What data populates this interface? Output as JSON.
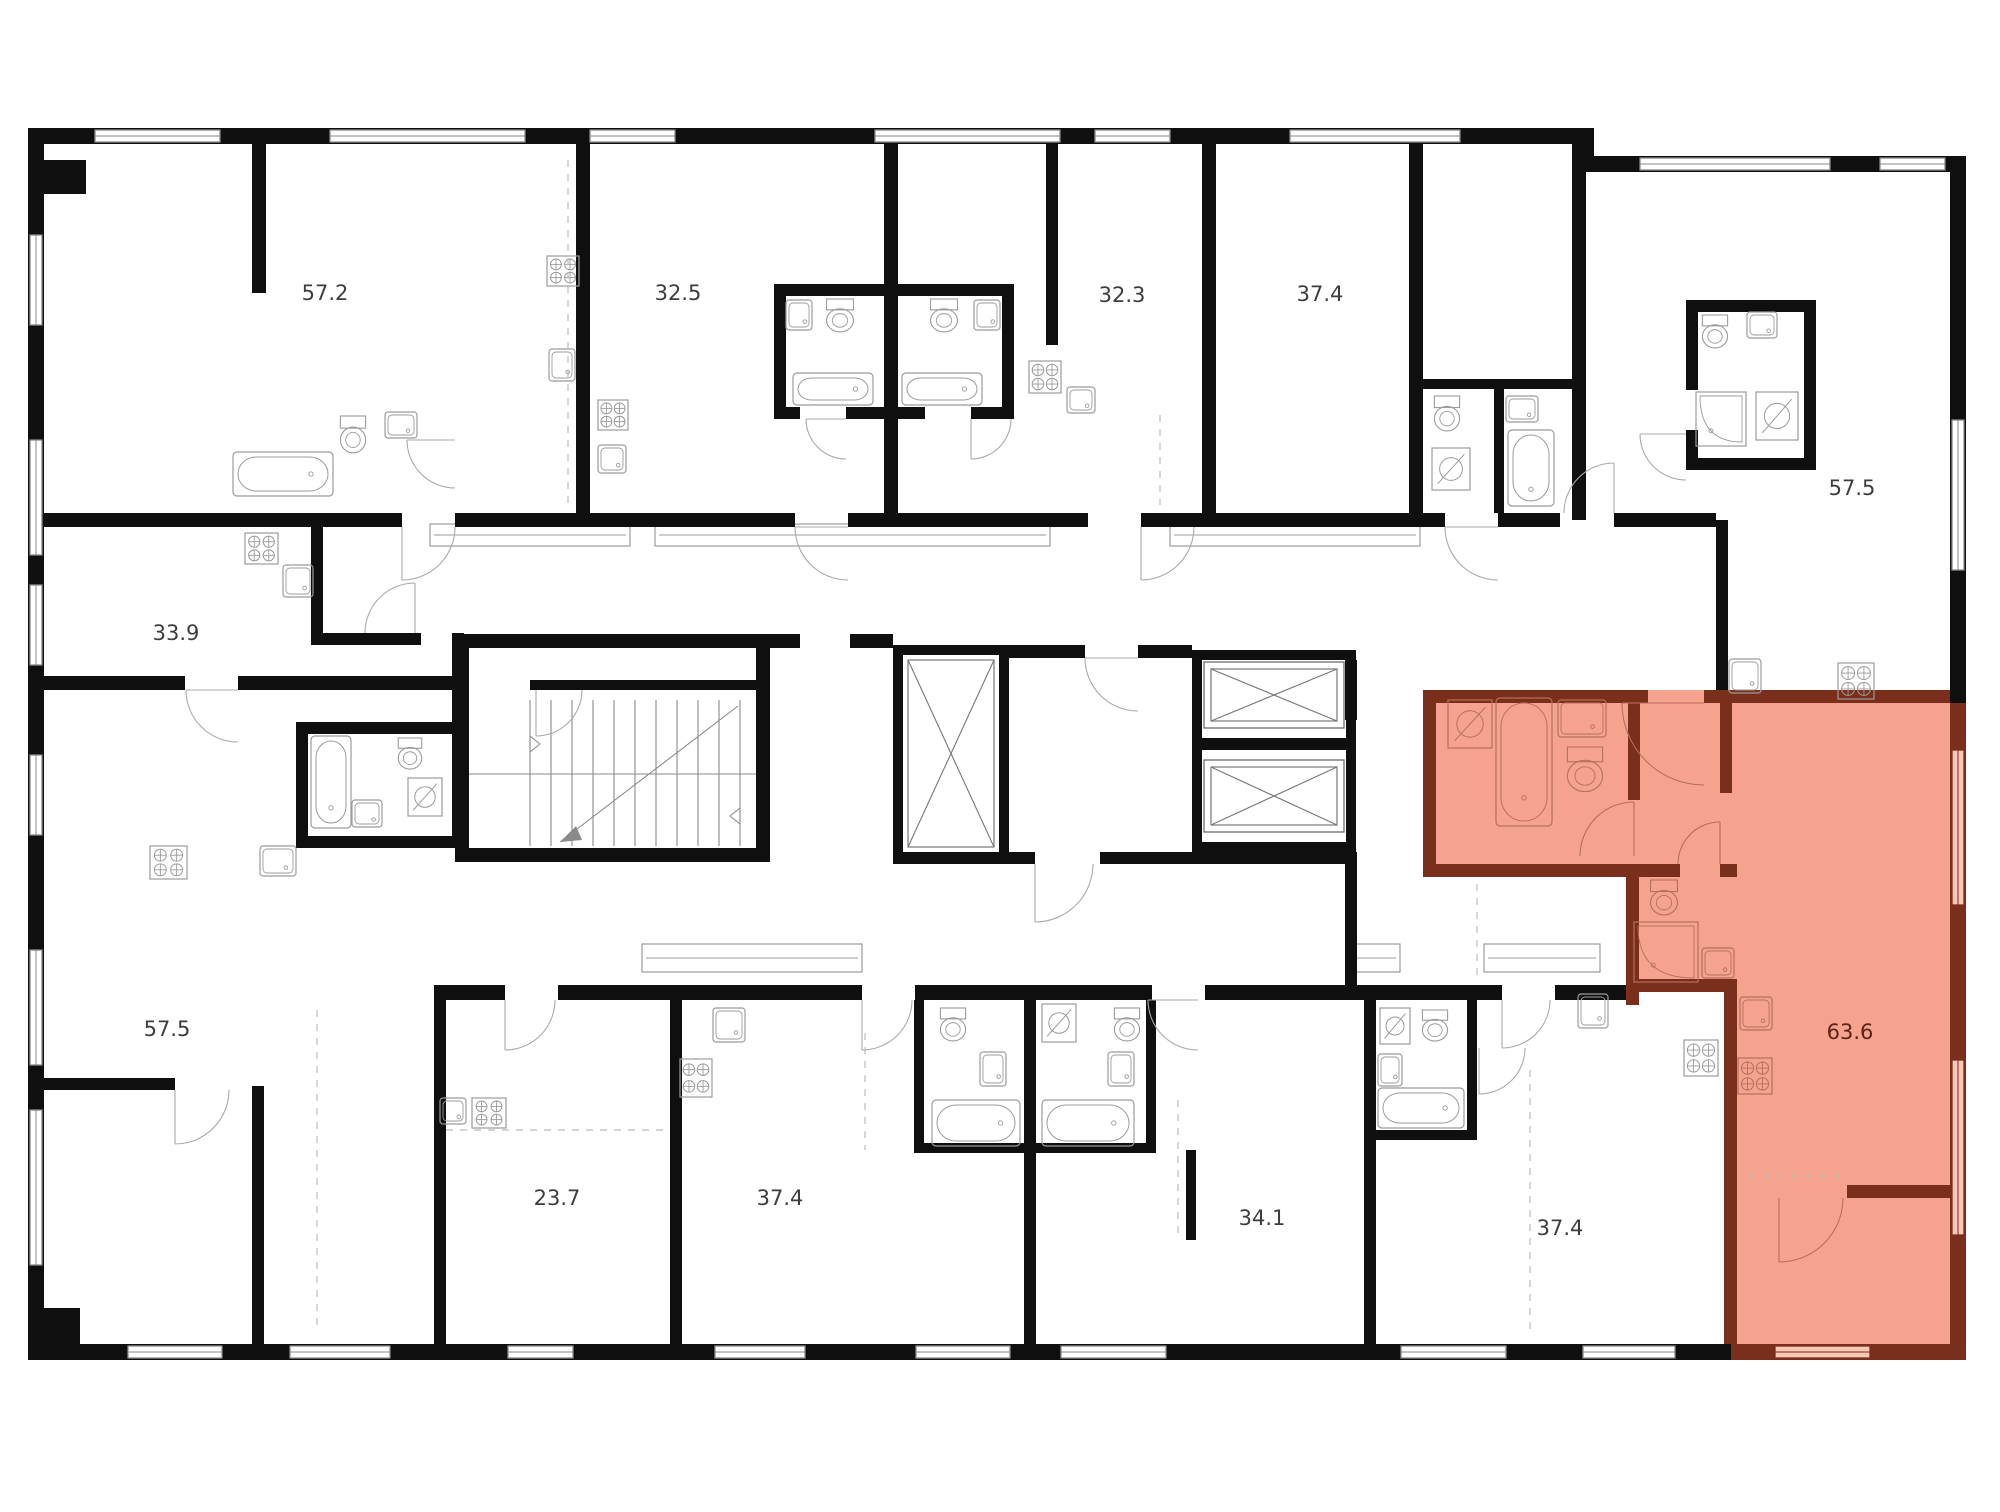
{
  "plan": {
    "title": "floor-plan",
    "colors": {
      "wall": "#0f0f0f",
      "highlight_fill": "#F5A38F",
      "highlight_wall": "#7A2E1C",
      "highlight_window_fill": "#F8C7B6",
      "highlight_label": "#5a2414",
      "fixture_line": "#9b9b9b",
      "fixture_line_selected": "#b5705a",
      "door_arc": "#aaaaaa",
      "dashed_line": "#bbbbbb",
      "label": "#3d3d3d",
      "background": "#ffffff"
    },
    "selected_apartment": {
      "area_label": "63.6"
    },
    "rooms": [
      {
        "label": "57.2",
        "x": 325,
        "y": 300,
        "selected": false
      },
      {
        "label": "32.5",
        "x": 678,
        "y": 300,
        "selected": false
      },
      {
        "label": "32.3",
        "x": 1122,
        "y": 302,
        "selected": false
      },
      {
        "label": "37.4",
        "x": 1320,
        "y": 301,
        "selected": false
      },
      {
        "label": "57.5",
        "x": 1852,
        "y": 495,
        "selected": false
      },
      {
        "label": "33.9",
        "x": 176,
        "y": 640,
        "selected": false
      },
      {
        "label": "57.5",
        "x": 167,
        "y": 1036,
        "selected": false
      },
      {
        "label": "23.7",
        "x": 557,
        "y": 1205,
        "selected": false
      },
      {
        "label": "37.4",
        "x": 780,
        "y": 1205,
        "selected": false
      },
      {
        "label": "34.1",
        "x": 1262,
        "y": 1225,
        "selected": false
      },
      {
        "label": "37.4",
        "x": 1560,
        "y": 1235,
        "selected": false
      },
      {
        "label": "63.6",
        "x": 1850,
        "y": 1039,
        "selected": true
      }
    ],
    "fixtures": [
      {
        "type": "stove",
        "name": "stove-icon",
        "x": 547,
        "y": 256,
        "w": 32,
        "h": 30,
        "sel": false
      },
      {
        "type": "sink",
        "name": "kitchen-sink-icon",
        "x": 549,
        "y": 349,
        "w": 26,
        "h": 32,
        "sel": false
      },
      {
        "type": "toilet",
        "name": "toilet-icon",
        "x": 338,
        "y": 416,
        "w": 30,
        "h": 38,
        "sel": false
      },
      {
        "type": "sink",
        "name": "bathroom-sink-icon",
        "x": 385,
        "y": 412,
        "w": 32,
        "h": 26,
        "sel": false
      },
      {
        "type": "tub-h",
        "name": "bathtub-icon",
        "x": 233,
        "y": 452,
        "w": 100,
        "h": 44,
        "sel": false
      },
      {
        "type": "stove",
        "name": "stove-icon",
        "x": 598,
        "y": 400,
        "w": 30,
        "h": 30,
        "sel": false
      },
      {
        "type": "sink",
        "name": "kitchen-sink-icon",
        "x": 598,
        "y": 445,
        "w": 28,
        "h": 28,
        "sel": false
      },
      {
        "type": "toilet",
        "name": "toilet-icon",
        "x": 824,
        "y": 299,
        "w": 32,
        "h": 34,
        "sel": false
      },
      {
        "type": "sink",
        "name": "bathroom-sink-icon",
        "x": 786,
        "y": 300,
        "w": 26,
        "h": 30,
        "sel": false
      },
      {
        "type": "tub-h",
        "name": "bathtub-icon",
        "x": 793,
        "y": 373,
        "w": 80,
        "h": 32,
        "sel": false
      },
      {
        "type": "toilet",
        "name": "toilet-icon",
        "x": 928,
        "y": 299,
        "w": 32,
        "h": 34,
        "sel": false
      },
      {
        "type": "sink",
        "name": "bathroom-sink-icon",
        "x": 974,
        "y": 300,
        "w": 26,
        "h": 30,
        "sel": false
      },
      {
        "type": "tub-h",
        "name": "bathtub-icon",
        "x": 902,
        "y": 373,
        "w": 80,
        "h": 32,
        "sel": false
      },
      {
        "type": "stove",
        "name": "stove-icon",
        "x": 1029,
        "y": 361,
        "w": 32,
        "h": 32,
        "sel": false
      },
      {
        "type": "sink",
        "name": "kitchen-sink-icon",
        "x": 1067,
        "y": 387,
        "w": 28,
        "h": 26,
        "sel": false
      },
      {
        "type": "toilet",
        "name": "toilet-icon",
        "x": 1432,
        "y": 396,
        "w": 30,
        "h": 36,
        "sel": false
      },
      {
        "type": "washer",
        "name": "washing-machine-icon",
        "x": 1432,
        "y": 448,
        "w": 38,
        "h": 42,
        "sel": false
      },
      {
        "type": "sink",
        "name": "bathroom-sink-icon",
        "x": 1506,
        "y": 396,
        "w": 32,
        "h": 26,
        "sel": false
      },
      {
        "type": "tub-v",
        "name": "bathtub-icon",
        "x": 1508,
        "y": 430,
        "w": 46,
        "h": 76,
        "sel": false
      },
      {
        "type": "toilet",
        "name": "toilet-icon",
        "x": 1700,
        "y": 315,
        "w": 30,
        "h": 34,
        "sel": false
      },
      {
        "type": "sink",
        "name": "bathroom-sink-icon",
        "x": 1747,
        "y": 312,
        "w": 30,
        "h": 26,
        "sel": false
      },
      {
        "type": "shower",
        "name": "shower-icon",
        "x": 1696,
        "y": 392,
        "w": 50,
        "h": 54,
        "sel": false
      },
      {
        "type": "washer",
        "name": "washing-machine-icon",
        "x": 1756,
        "y": 392,
        "w": 42,
        "h": 48,
        "sel": false
      },
      {
        "type": "sink",
        "name": "kitchen-sink-icon",
        "x": 1729,
        "y": 659,
        "w": 32,
        "h": 34,
        "sel": false
      },
      {
        "type": "stove",
        "name": "stove-icon",
        "x": 1838,
        "y": 663,
        "w": 36,
        "h": 36,
        "sel": false
      },
      {
        "type": "stove",
        "name": "stove-icon",
        "x": 245,
        "y": 533,
        "w": 33,
        "h": 31,
        "sel": false
      },
      {
        "type": "sink",
        "name": "kitchen-sink-icon",
        "x": 283,
        "y": 565,
        "w": 30,
        "h": 32,
        "sel": false
      },
      {
        "type": "tub-v",
        "name": "bathtub-icon",
        "x": 311,
        "y": 736,
        "w": 40,
        "h": 92,
        "sel": false
      },
      {
        "type": "toilet",
        "name": "toilet-icon",
        "x": 396,
        "y": 738,
        "w": 28,
        "h": 32,
        "sel": false
      },
      {
        "type": "sink",
        "name": "bathroom-sink-icon",
        "x": 352,
        "y": 800,
        "w": 30,
        "h": 27,
        "sel": false
      },
      {
        "type": "washer",
        "name": "washing-machine-icon",
        "x": 408,
        "y": 778,
        "w": 34,
        "h": 38,
        "sel": false
      },
      {
        "type": "stove",
        "name": "stove-icon",
        "x": 150,
        "y": 846,
        "w": 37,
        "h": 33,
        "sel": false
      },
      {
        "type": "sink",
        "name": "kitchen-sink-icon",
        "x": 260,
        "y": 846,
        "w": 36,
        "h": 30,
        "sel": false
      },
      {
        "type": "sink",
        "name": "kitchen-sink-icon",
        "x": 440,
        "y": 1098,
        "w": 26,
        "h": 26,
        "sel": false
      },
      {
        "type": "stove",
        "name": "stove-icon",
        "x": 472,
        "y": 1098,
        "w": 34,
        "h": 30,
        "sel": false
      },
      {
        "type": "sink",
        "name": "kitchen-sink-icon",
        "x": 713,
        "y": 1008,
        "w": 32,
        "h": 34,
        "sel": false
      },
      {
        "type": "stove",
        "name": "stove-icon",
        "x": 680,
        "y": 1059,
        "w": 32,
        "h": 38,
        "sel": false
      },
      {
        "type": "toilet",
        "name": "toilet-icon",
        "x": 938,
        "y": 1008,
        "w": 30,
        "h": 34,
        "sel": false
      },
      {
        "type": "sink",
        "name": "bathroom-sink-icon",
        "x": 980,
        "y": 1052,
        "w": 26,
        "h": 34,
        "sel": false
      },
      {
        "type": "tub-h",
        "name": "bathtub-icon",
        "x": 932,
        "y": 1100,
        "w": 88,
        "h": 46,
        "sel": false
      },
      {
        "type": "washer",
        "name": "washing-machine-icon",
        "x": 1042,
        "y": 1004,
        "w": 34,
        "h": 38,
        "sel": false
      },
      {
        "type": "toilet",
        "name": "toilet-icon",
        "x": 1112,
        "y": 1008,
        "w": 30,
        "h": 34,
        "sel": false
      },
      {
        "type": "sink",
        "name": "bathroom-sink-icon",
        "x": 1108,
        "y": 1052,
        "w": 26,
        "h": 34,
        "sel": false
      },
      {
        "type": "tub-h",
        "name": "bathtub-icon",
        "x": 1042,
        "y": 1100,
        "w": 92,
        "h": 46,
        "sel": false
      },
      {
        "type": "washer",
        "name": "washing-machine-icon",
        "x": 1380,
        "y": 1008,
        "w": 30,
        "h": 36,
        "sel": false
      },
      {
        "type": "toilet",
        "name": "toilet-icon",
        "x": 1420,
        "y": 1010,
        "w": 30,
        "h": 32,
        "sel": false
      },
      {
        "type": "sink",
        "name": "bathroom-sink-icon",
        "x": 1378,
        "y": 1054,
        "w": 24,
        "h": 32,
        "sel": false
      },
      {
        "type": "tub-h",
        "name": "bathtub-icon",
        "x": 1378,
        "y": 1088,
        "w": 86,
        "h": 40,
        "sel": false
      },
      {
        "type": "sink",
        "name": "kitchen-sink-icon",
        "x": 1578,
        "y": 994,
        "w": 30,
        "h": 34,
        "sel": false
      },
      {
        "type": "stove",
        "name": "stove-icon",
        "x": 1684,
        "y": 1040,
        "w": 34,
        "h": 36,
        "sel": false
      },
      {
        "type": "washer",
        "name": "washing-machine-icon",
        "x": 1448,
        "y": 700,
        "w": 44,
        "h": 48,
        "sel": true
      },
      {
        "type": "tub-v",
        "name": "bathtub-icon",
        "x": 1496,
        "y": 698,
        "w": 56,
        "h": 128,
        "sel": true
      },
      {
        "type": "sink",
        "name": "bathroom-sink-icon",
        "x": 1558,
        "y": 700,
        "w": 48,
        "h": 37,
        "sel": true
      },
      {
        "type": "toilet",
        "name": "toilet-icon",
        "x": 1564,
        "y": 747,
        "w": 42,
        "h": 46,
        "sel": true
      },
      {
        "type": "toilet",
        "name": "toilet-icon",
        "x": 1648,
        "y": 880,
        "w": 32,
        "h": 36,
        "sel": true
      },
      {
        "type": "shower",
        "name": "shower-icon",
        "x": 1634,
        "y": 922,
        "w": 64,
        "h": 60,
        "sel": true
      },
      {
        "type": "sink",
        "name": "bathroom-sink-icon",
        "x": 1702,
        "y": 948,
        "w": 32,
        "h": 30,
        "sel": true
      },
      {
        "type": "sink",
        "name": "kitchen-sink-icon",
        "x": 1740,
        "y": 997,
        "w": 32,
        "h": 33,
        "sel": true
      },
      {
        "type": "stove",
        "name": "stove-icon",
        "x": 1738,
        "y": 1058,
        "w": 34,
        "h": 36,
        "sel": true
      }
    ]
  }
}
